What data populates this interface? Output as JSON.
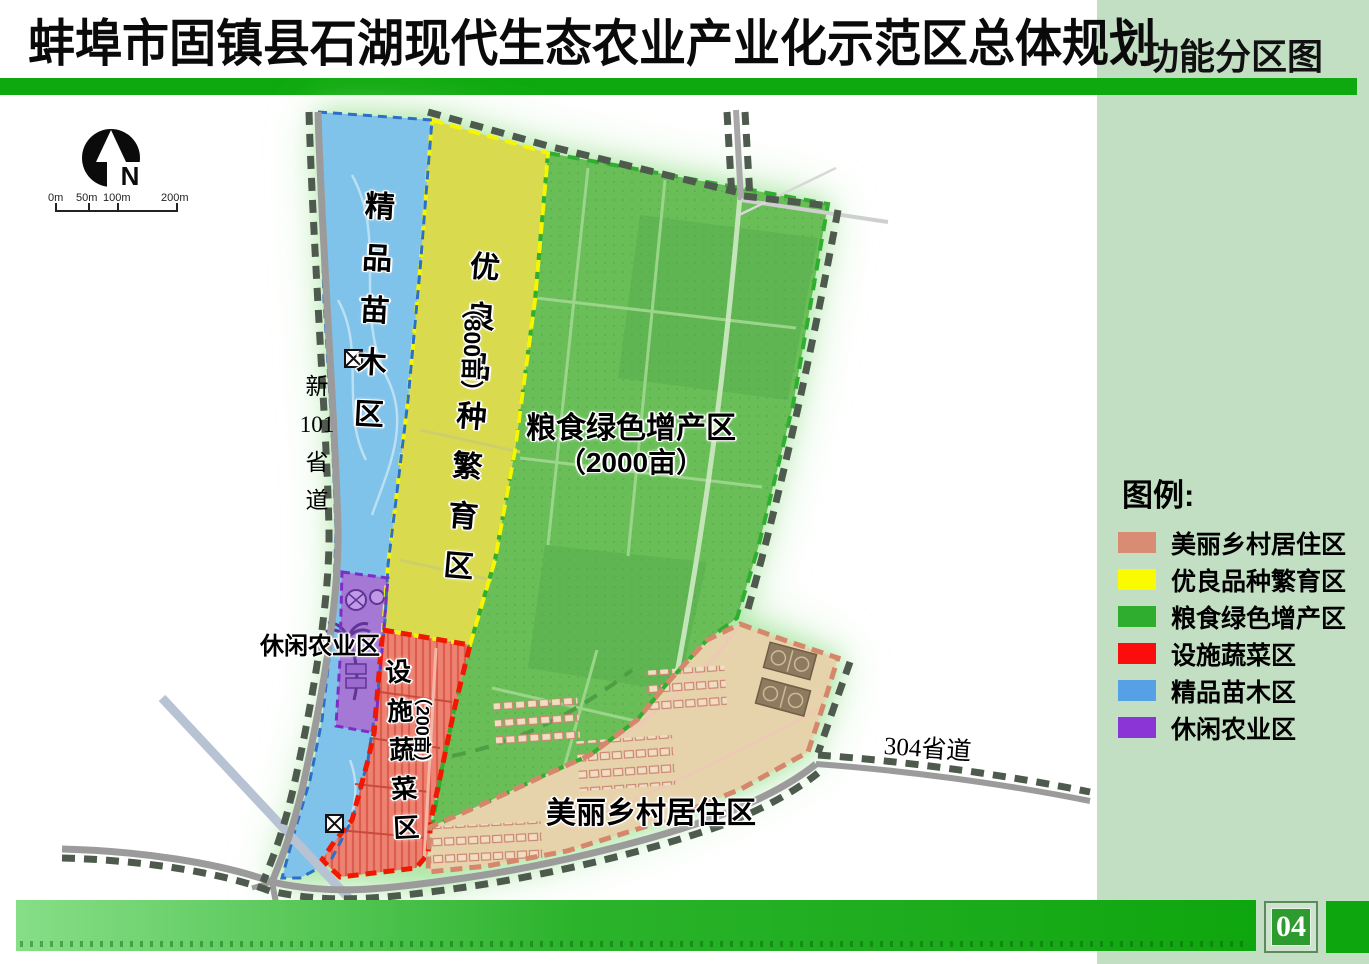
{
  "header": {
    "title": "蚌埠市固镇县石湖现代生态农业产业化示范区总体规划",
    "map_name": "功能分区图"
  },
  "compass": {
    "north_label": "N"
  },
  "scale_bar": {
    "ticks": [
      "0m",
      "50m",
      "100m",
      "200m"
    ]
  },
  "map_colors": {
    "nursery": "#7fc2ea",
    "breeding": "#d9da4e",
    "grain": "#69be58",
    "vegetable": "#ee8272",
    "leisure": "#a678d6",
    "village": "#e7d3ab",
    "glow": "#a5e49d"
  },
  "map_labels": {
    "nursery": "精品苗木区",
    "breeding": "优良品种繁育区",
    "breeding_area": "（800亩）",
    "grain": "粮食绿色增产区",
    "grain_area": "（2000亩）",
    "vegetable": "设施蔬菜区",
    "vegetable_area": "（200亩）",
    "leisure": "休闲农业区",
    "village": "美丽乡村居住区",
    "road_101_line1": "新",
    "road_101_line2": "101",
    "road_101_line3": "省",
    "road_101_line4": "道",
    "road_304": "304省道"
  },
  "legend": {
    "title": "图例:",
    "items": [
      {
        "label": "美丽乡村居住区",
        "color": "#d98c74"
      },
      {
        "label": "优良品种繁育区",
        "color": "#fbfb00"
      },
      {
        "label": "粮食绿色增产区",
        "color": "#2fad2f"
      },
      {
        "label": "设施蔬菜区",
        "color": "#fb0d0d"
      },
      {
        "label": "精品苗木区",
        "color": "#56a0e6"
      },
      {
        "label": "休闲农业区",
        "color": "#8c35d6"
      }
    ]
  },
  "footer": {
    "page_number": "04"
  }
}
